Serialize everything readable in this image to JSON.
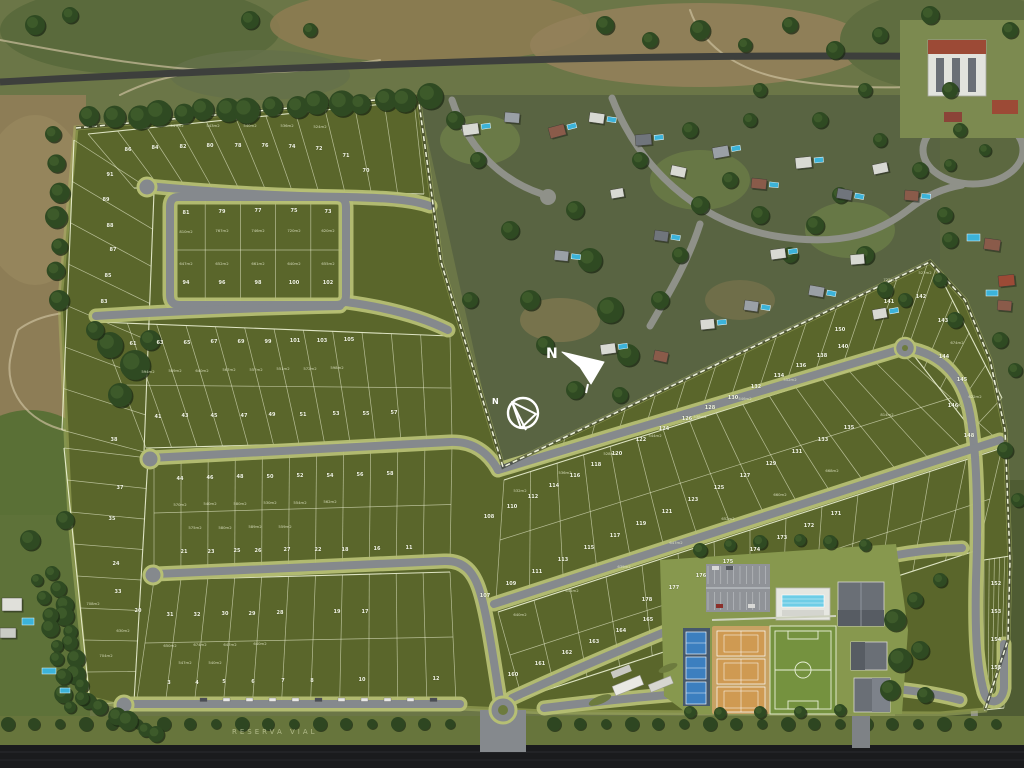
{
  "map": {
    "title": "residential-masterplan-aerial",
    "compass": {
      "north_label": "N"
    },
    "road_label": "RESERVA VIAL",
    "colors": {
      "lot_green": "#5a662b",
      "buffer_green": "#b6bf74",
      "road_gray": "#85898d",
      "avenue_dark": "#1a1b1d",
      "court_blue": "#3c7fbf",
      "clay_tan": "#c7a264",
      "pitch_green": "#75923f",
      "pool_blue": "#3cb3d9"
    },
    "lot_numbers": [
      [
        "86",
        128,
        151
      ],
      [
        "84",
        155,
        149
      ],
      [
        "82",
        183,
        148
      ],
      [
        "80",
        210,
        147
      ],
      [
        "78",
        238,
        147
      ],
      [
        "76",
        265,
        147
      ],
      [
        "74",
        292,
        148
      ],
      [
        "72",
        319,
        150
      ],
      [
        "71",
        346,
        157
      ],
      [
        "70",
        366,
        172
      ],
      [
        "81",
        186,
        214
      ],
      [
        "79",
        222,
        213
      ],
      [
        "77",
        258,
        212
      ],
      [
        "75",
        294,
        212
      ],
      [
        "73",
        328,
        213
      ],
      [
        "94",
        186,
        284
      ],
      [
        "96",
        222,
        284
      ],
      [
        "98",
        258,
        284
      ],
      [
        "100",
        294,
        284
      ],
      [
        "102",
        328,
        284
      ],
      [
        "91",
        110,
        176
      ],
      [
        "89",
        106,
        201
      ],
      [
        "88",
        110,
        227
      ],
      [
        "87",
        113,
        251
      ],
      [
        "85",
        108,
        277
      ],
      [
        "83",
        104,
        303
      ],
      [
        "61",
        133,
        345
      ],
      [
        "63",
        160,
        344
      ],
      [
        "65",
        187,
        344
      ],
      [
        "67",
        214,
        343
      ],
      [
        "69",
        241,
        343
      ],
      [
        "99",
        268,
        343
      ],
      [
        "101",
        295,
        342
      ],
      [
        "103",
        322,
        342
      ],
      [
        "105",
        349,
        341
      ],
      [
        "38",
        114,
        441
      ],
      [
        "41",
        158,
        418
      ],
      [
        "43",
        185,
        417
      ],
      [
        "45",
        214,
        417
      ],
      [
        "47",
        244,
        417
      ],
      [
        "49",
        272,
        416
      ],
      [
        "51",
        303,
        416
      ],
      [
        "53",
        336,
        415
      ],
      [
        "55",
        366,
        415
      ],
      [
        "57",
        394,
        414
      ],
      [
        "44",
        180,
        480
      ],
      [
        "46",
        210,
        479
      ],
      [
        "48",
        240,
        478
      ],
      [
        "50",
        270,
        478
      ],
      [
        "52",
        300,
        477
      ],
      [
        "54",
        330,
        477
      ],
      [
        "56",
        360,
        476
      ],
      [
        "58",
        390,
        475
      ],
      [
        "37",
        120,
        489
      ],
      [
        "35",
        112,
        520
      ],
      [
        "21",
        184,
        553
      ],
      [
        "23",
        211,
        553
      ],
      [
        "25",
        237,
        552
      ],
      [
        "26",
        258,
        552
      ],
      [
        "27",
        287,
        551
      ],
      [
        "22",
        318,
        551
      ],
      [
        "18",
        345,
        551
      ],
      [
        "16",
        377,
        550
      ],
      [
        "11",
        409,
        549
      ],
      [
        "24",
        116,
        565
      ],
      [
        "33",
        118,
        593
      ],
      [
        "20",
        138,
        612
      ],
      [
        "31",
        170,
        616
      ],
      [
        "32",
        197,
        616
      ],
      [
        "30",
        225,
        615
      ],
      [
        "29",
        252,
        615
      ],
      [
        "28",
        280,
        614
      ],
      [
        "19",
        337,
        613
      ],
      [
        "17",
        365,
        613
      ],
      [
        "3",
        169,
        684
      ],
      [
        "4",
        197,
        684
      ],
      [
        "5",
        224,
        683
      ],
      [
        "6",
        253,
        683
      ],
      [
        "7",
        283,
        682
      ],
      [
        "8",
        312,
        682
      ],
      [
        "10",
        362,
        681
      ],
      [
        "12",
        436,
        680
      ],
      [
        "108",
        489,
        518
      ],
      [
        "110",
        512,
        508
      ],
      [
        "112",
        533,
        498
      ],
      [
        "114",
        554,
        487
      ],
      [
        "116",
        575,
        477
      ],
      [
        "118",
        596,
        466
      ],
      [
        "120",
        617,
        455
      ],
      [
        "122",
        641,
        441
      ],
      [
        "124",
        664,
        430
      ],
      [
        "126",
        687,
        420
      ],
      [
        "128",
        710,
        409
      ],
      [
        "130",
        733,
        399
      ],
      [
        "132",
        756,
        388
      ],
      [
        "134",
        779,
        377
      ],
      [
        "136",
        801,
        367
      ],
      [
        "138",
        822,
        357
      ],
      [
        "140",
        843,
        348
      ],
      [
        "141",
        889,
        303
      ],
      [
        "142",
        921,
        298
      ],
      [
        "143",
        943,
        322
      ],
      [
        "144",
        944,
        358
      ],
      [
        "145",
        962,
        381
      ],
      [
        "146",
        953,
        407
      ],
      [
        "148",
        969,
        437
      ],
      [
        "150",
        840,
        331
      ],
      [
        "107",
        485,
        597
      ],
      [
        "109",
        511,
        585
      ],
      [
        "111",
        537,
        573
      ],
      [
        "113",
        563,
        561
      ],
      [
        "115",
        589,
        549
      ],
      [
        "117",
        615,
        537
      ],
      [
        "119",
        641,
        525
      ],
      [
        "121",
        667,
        513
      ],
      [
        "123",
        693,
        501
      ],
      [
        "125",
        719,
        489
      ],
      [
        "127",
        745,
        477
      ],
      [
        "129",
        771,
        465
      ],
      [
        "131",
        797,
        453
      ],
      [
        "133",
        823,
        441
      ],
      [
        "135",
        849,
        429
      ],
      [
        "160",
        513,
        676
      ],
      [
        "161",
        540,
        665
      ],
      [
        "162",
        567,
        654
      ],
      [
        "163",
        594,
        643
      ],
      [
        "164",
        621,
        632
      ],
      [
        "165",
        648,
        621
      ],
      [
        "178",
        647,
        601
      ],
      [
        "177",
        674,
        589
      ],
      [
        "176",
        701,
        577
      ],
      [
        "175",
        728,
        563
      ],
      [
        "174",
        755,
        551
      ],
      [
        "173",
        782,
        539
      ],
      [
        "172",
        809,
        527
      ],
      [
        "171",
        836,
        515
      ],
      [
        "152",
        996,
        585
      ],
      [
        "153",
        996,
        613
      ],
      [
        "154",
        996,
        641
      ],
      [
        "155",
        996,
        669
      ]
    ],
    "lot_areas": [
      [
        "547m2",
        177,
        127
      ],
      [
        "543m2",
        213,
        127
      ],
      [
        "540m2",
        250,
        127
      ],
      [
        "536m2",
        287,
        127
      ],
      [
        "524m2",
        320,
        128
      ],
      [
        "810m2",
        186,
        233
      ],
      [
        "767m2",
        222,
        232
      ],
      [
        "746m2",
        258,
        232
      ],
      [
        "720m2",
        294,
        232
      ],
      [
        "620m2",
        328,
        232
      ],
      [
        "647m2",
        186,
        265
      ],
      [
        "652m2",
        222,
        265
      ],
      [
        "661m2",
        258,
        265
      ],
      [
        "640m2",
        294,
        265
      ],
      [
        "655m2",
        328,
        265
      ],
      [
        "594m2",
        148,
        373
      ],
      [
        "589m2",
        175,
        372
      ],
      [
        "640m2",
        202,
        372
      ],
      [
        "567m2",
        229,
        371
      ],
      [
        "557m2",
        256,
        371
      ],
      [
        "551m2",
        283,
        370
      ],
      [
        "572m2",
        310,
        370
      ],
      [
        "598m2",
        337,
        369
      ],
      [
        "570m2",
        180,
        506
      ],
      [
        "540m2",
        210,
        505
      ],
      [
        "580m2",
        240,
        505
      ],
      [
        "530m2",
        270,
        504
      ],
      [
        "554m2",
        300,
        504
      ],
      [
        "562m2",
        330,
        503
      ],
      [
        "575m2",
        195,
        529
      ],
      [
        "580m2",
        225,
        529
      ],
      [
        "589m2",
        255,
        528
      ],
      [
        "559m2",
        285,
        528
      ],
      [
        "650m2",
        170,
        647
      ],
      [
        "674m2",
        200,
        646
      ],
      [
        "647m2",
        230,
        646
      ],
      [
        "640m2",
        260,
        645
      ],
      [
        "547m2",
        185,
        664
      ],
      [
        "540m2",
        215,
        664
      ],
      [
        "708m2",
        93,
        605
      ],
      [
        "630m2",
        123,
        632
      ],
      [
        "704m2",
        106,
        657
      ],
      [
        "532m2",
        520,
        492
      ],
      [
        "536m2",
        565,
        474
      ],
      [
        "528m2",
        610,
        455
      ],
      [
        "544m2",
        655,
        437
      ],
      [
        "538m2",
        700,
        418
      ],
      [
        "546m2",
        745,
        400
      ],
      [
        "552m2",
        790,
        381
      ],
      [
        "640m2",
        520,
        616
      ],
      [
        "641m2",
        572,
        592
      ],
      [
        "639m2",
        624,
        568
      ],
      [
        "647m2",
        676,
        544
      ],
      [
        "652m2",
        728,
        520
      ],
      [
        "660m2",
        780,
        496
      ],
      [
        "668m2",
        832,
        472
      ],
      [
        "722m2",
        890,
        281
      ],
      [
        "527m2",
        925,
        274
      ],
      [
        "674m2",
        957,
        344
      ],
      [
        "622m2",
        975,
        398
      ],
      [
        "814m2",
        887,
        416
      ]
    ]
  }
}
